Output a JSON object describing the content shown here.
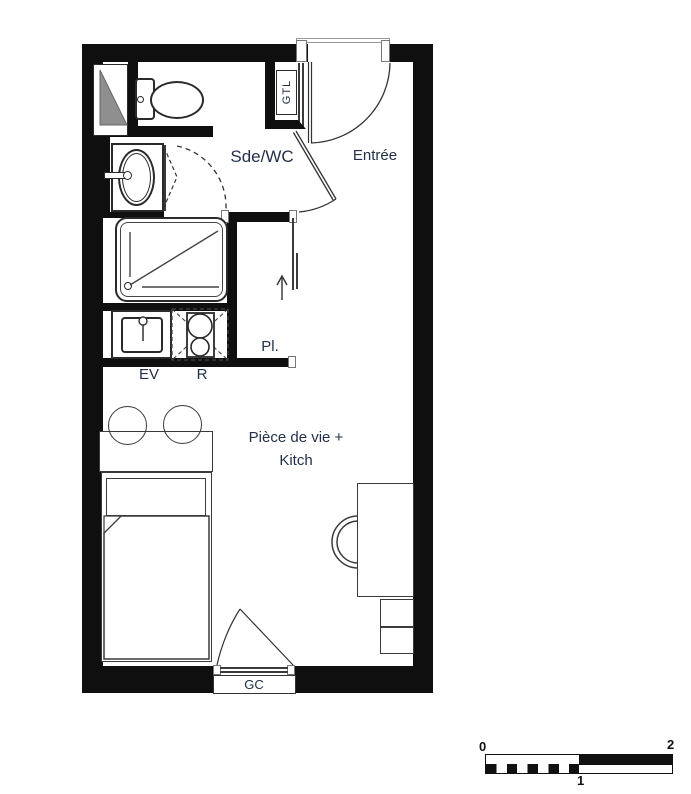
{
  "title": "Studio apartment floor plan",
  "rooms": {
    "bathroom_label": "Sde/WC",
    "entry_label": "Entrée",
    "closet_label": "Pl.",
    "living_label_line1": "Pièce de vie +",
    "living_label_line2": "Kitch"
  },
  "fixtures": {
    "electrical_cabinet_label": "GTL",
    "kitchen_sink_label": "EV",
    "cooktop_label": "R",
    "guardrail_label": "GC"
  },
  "scale_bar": {
    "start": "0",
    "mid": "1",
    "end": "2"
  },
  "colors": {
    "wall": "#0f0f0f",
    "label": "#22304a",
    "shaft": "#8f8f8f",
    "line": "#3a3a3a"
  }
}
